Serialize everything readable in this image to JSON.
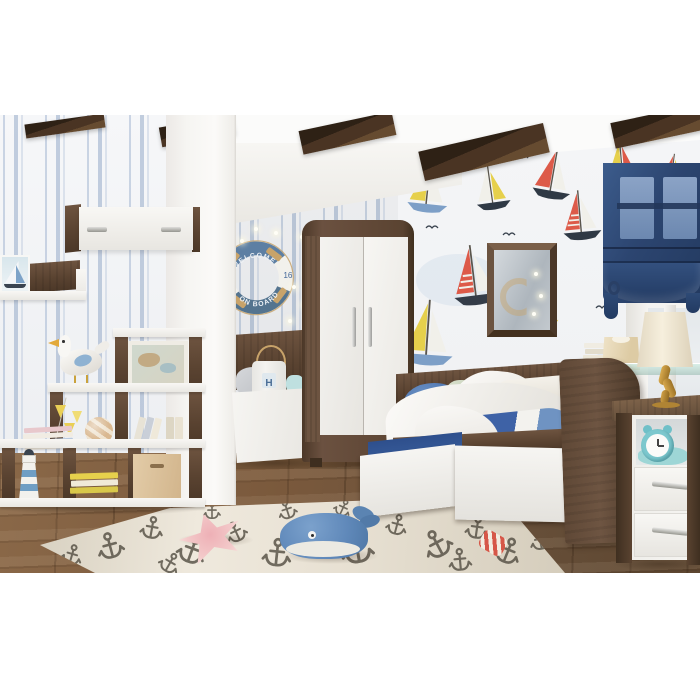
{
  "scene_title": "Nautical kids bedroom with walnut and white furniture",
  "lifebuoy": {
    "top_text": "WELCOME",
    "bottom_text": "ON BOARD",
    "number": "16"
  },
  "toy_bucket": {
    "label": "H"
  },
  "palette": {
    "wood_dark": "#4e3a2b",
    "wood": "#6b5340",
    "white_furniture": "#f3f2ef",
    "stripe_blue": "#c9d4e4",
    "blind_navy": "#2f4a76",
    "bedding_blue": "#3e62a6",
    "sail_red": "#dd5a49",
    "sail_yellow": "#e6d04c",
    "sail_blue": "#7d9fc7",
    "floor_brown": "#7a593c",
    "rug_cream": "#e9e2d4",
    "anchor_gray": "#4e483d",
    "rope_tan": "#c8a36a",
    "lifebuoy_blue": "#5d7fa3"
  },
  "wallpaper": {
    "washes": [
      {
        "x": 60,
        "y": 140,
        "rx": 42,
        "ry": 26
      },
      {
        "x": 160,
        "y": 330,
        "rx": 58,
        "ry": 30
      },
      {
        "x": 250,
        "y": 60,
        "rx": 36,
        "ry": 22
      },
      {
        "x": 40,
        "y": 298,
        "rx": 30,
        "ry": 20
      },
      {
        "x": 230,
        "y": 230,
        "rx": 40,
        "ry": 24
      }
    ],
    "boats": [
      {
        "x": 12,
        "y": 18,
        "s": 1.0,
        "r": 6,
        "main": "#e6d04c",
        "jib": "#f1f0ea",
        "hull": "#7d9fc7"
      },
      {
        "x": 72,
        "y": 28,
        "s": 0.85,
        "r": -8,
        "main": "#f1f0ea",
        "jib": "#e6d04c",
        "hull": "#2f3945"
      },
      {
        "x": 140,
        "y": 6,
        "s": 0.95,
        "r": 10,
        "main": "#dd5a49",
        "jib": "#f1f0ea",
        "hull": "#2f3945"
      },
      {
        "x": 205,
        "y": 2,
        "s": 0.8,
        "r": -5,
        "main": "#e6d04c",
        "jib": "#dd5a49",
        "hull": "#6b88a8"
      },
      {
        "x": 262,
        "y": 12,
        "s": 0.7,
        "r": 7,
        "main": "#dd5a49",
        "jib": "#e6d04c",
        "hull": "#3a4450"
      },
      {
        "x": 48,
        "y": 108,
        "s": 1.15,
        "r": -7,
        "main": "#dd5a49",
        "jib": "#f1f0ea",
        "hull": "#343c48",
        "st": true
      },
      {
        "x": 6,
        "y": 158,
        "s": 1.25,
        "r": 4,
        "main": "#e6d04c",
        "jib": "#f1f0ea",
        "hull": "#7d9fc7"
      },
      {
        "x": 112,
        "y": 148,
        "s": 0.95,
        "r": -13,
        "main": "#9fb6cf",
        "jib": "#f1f0ea",
        "hull": "#e6d04c"
      },
      {
        "x": 160,
        "y": 52,
        "s": 0.95,
        "r": -5,
        "main": "#dd5a49",
        "jib": "#f1f0ea",
        "hull": "#2f3945",
        "st": true
      },
      {
        "x": 10,
        "y": 252,
        "s": 1.15,
        "r": -6,
        "main": "#dd5a49",
        "jib": "#3a4450",
        "hull": "#f1f0ea"
      },
      {
        "x": 62,
        "y": 322,
        "s": 1.0,
        "r": 8,
        "main": "#e6d04c",
        "jib": "#dd5a49",
        "hull": "#3a4450"
      },
      {
        "x": 186,
        "y": 298,
        "s": 0.9,
        "r": -9,
        "main": "#e6d04c",
        "jib": "#2f3945",
        "hull": "#dd5a49"
      },
      {
        "x": 264,
        "y": 305,
        "s": 0.8,
        "r": 5,
        "main": "#dd5a49",
        "jib": "#e6d04c",
        "hull": "#2f3945"
      }
    ],
    "birds": [
      {
        "x": 105,
        "y": 95
      },
      {
        "x": 232,
        "y": 118
      },
      {
        "x": 58,
        "y": 238
      },
      {
        "x": 152,
        "y": 228
      },
      {
        "x": 252,
        "y": 198
      },
      {
        "x": 118,
        "y": 18
      },
      {
        "x": 198,
        "y": 168
      },
      {
        "x": 28,
        "y": 88
      },
      {
        "x": 262,
        "y": 250
      },
      {
        "x": 80,
        "y": 300
      }
    ]
  },
  "rug": {
    "anchors": [
      {
        "x": 70,
        "y": 48,
        "s": 1.4,
        "r": -15
      },
      {
        "x": 112,
        "y": 30,
        "s": 1.2,
        "r": 10
      },
      {
        "x": 152,
        "y": 52,
        "s": 1.5,
        "r": 20
      },
      {
        "x": 196,
        "y": 34,
        "s": 1.1,
        "r": -25
      },
      {
        "x": 237,
        "y": 55,
        "s": 1.5,
        "r": 6
      },
      {
        "x": 277,
        "y": 30,
        "s": 1.2,
        "r": 28
      },
      {
        "x": 317,
        "y": 50,
        "s": 1.7,
        "r": -10
      },
      {
        "x": 357,
        "y": 27,
        "s": 1.1,
        "r": 15
      },
      {
        "x": 397,
        "y": 46,
        "s": 1.5,
        "r": -28
      },
      {
        "x": 437,
        "y": 30,
        "s": 1.2,
        "r": 8
      },
      {
        "x": 468,
        "y": 53,
        "s": 1.4,
        "r": 22
      },
      {
        "x": 247,
        "y": 12,
        "s": 1.0,
        "r": -18
      },
      {
        "x": 303,
        "y": 10,
        "s": 0.9,
        "r": 25
      },
      {
        "x": 172,
        "y": 13,
        "s": 0.9,
        "r": 0
      },
      {
        "x": 500,
        "y": 42,
        "s": 1.1,
        "r": -12
      },
      {
        "x": 32,
        "y": 57,
        "s": 1.1,
        "r": 16
      },
      {
        "x": 420,
        "y": 62,
        "s": 1.2,
        "r": -5
      },
      {
        "x": 130,
        "y": 65,
        "s": 1.1,
        "r": 30
      }
    ]
  },
  "string_lights": [
    {
      "x": 88,
      "y": 8
    },
    {
      "x": 100,
      "y": 24
    },
    {
      "x": 93,
      "y": 44
    },
    {
      "x": 80,
      "y": 58
    },
    {
      "x": 90,
      "y": 76
    },
    {
      "x": 102,
      "y": 92
    },
    {
      "x": 76,
      "y": 92
    },
    {
      "x": 62,
      "y": 4
    },
    {
      "x": 42,
      "y": 0
    },
    {
      "x": 28,
      "y": 12
    },
    {
      "x": 100,
      "y": 58
    }
  ]
}
